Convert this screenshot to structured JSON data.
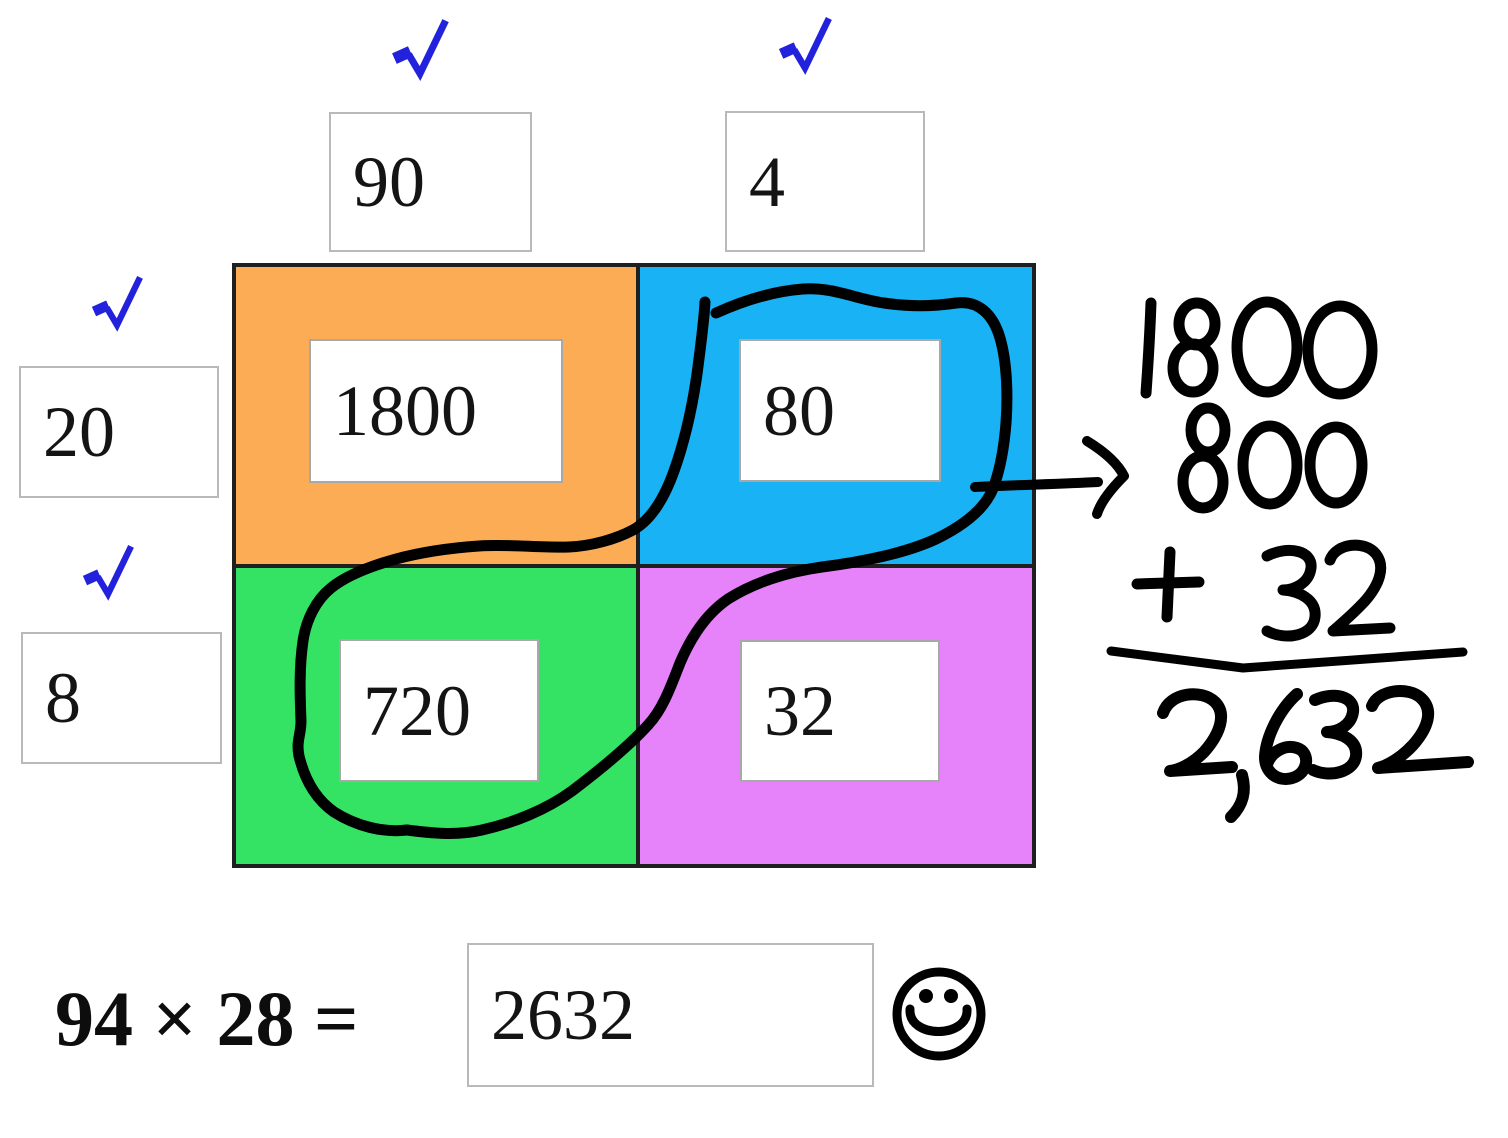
{
  "factors": {
    "top": [
      {
        "value": "90",
        "checked": true
      },
      {
        "value": "4",
        "checked": true
      }
    ],
    "left": [
      {
        "value": "20",
        "checked": true
      },
      {
        "value": "8",
        "checked": true
      }
    ]
  },
  "grid": {
    "cells": [
      {
        "name": "top-left",
        "value": "1800",
        "color": "#FBAC54"
      },
      {
        "name": "top-right",
        "value": "80",
        "color": "#18B2F5"
      },
      {
        "name": "bottom-left",
        "value": "720",
        "color": "#35E364"
      },
      {
        "name": "bottom-right",
        "value": "32",
        "color": "#E783FA"
      }
    ]
  },
  "handwriting": {
    "lines": [
      "1800",
      "800",
      "+ 32",
      "2,632"
    ],
    "annotation": "lasso circling 80 and 720 with arrow to 800"
  },
  "equation": {
    "expression": "94 × 28 =",
    "answer": "2632"
  },
  "icons": {
    "checkmark": "✓",
    "smiley": "☺"
  },
  "colors": {
    "check": "#2222DD",
    "ink": "#000000",
    "grid_border": "#1f1f1f",
    "input_border": "#b9b9b9"
  }
}
